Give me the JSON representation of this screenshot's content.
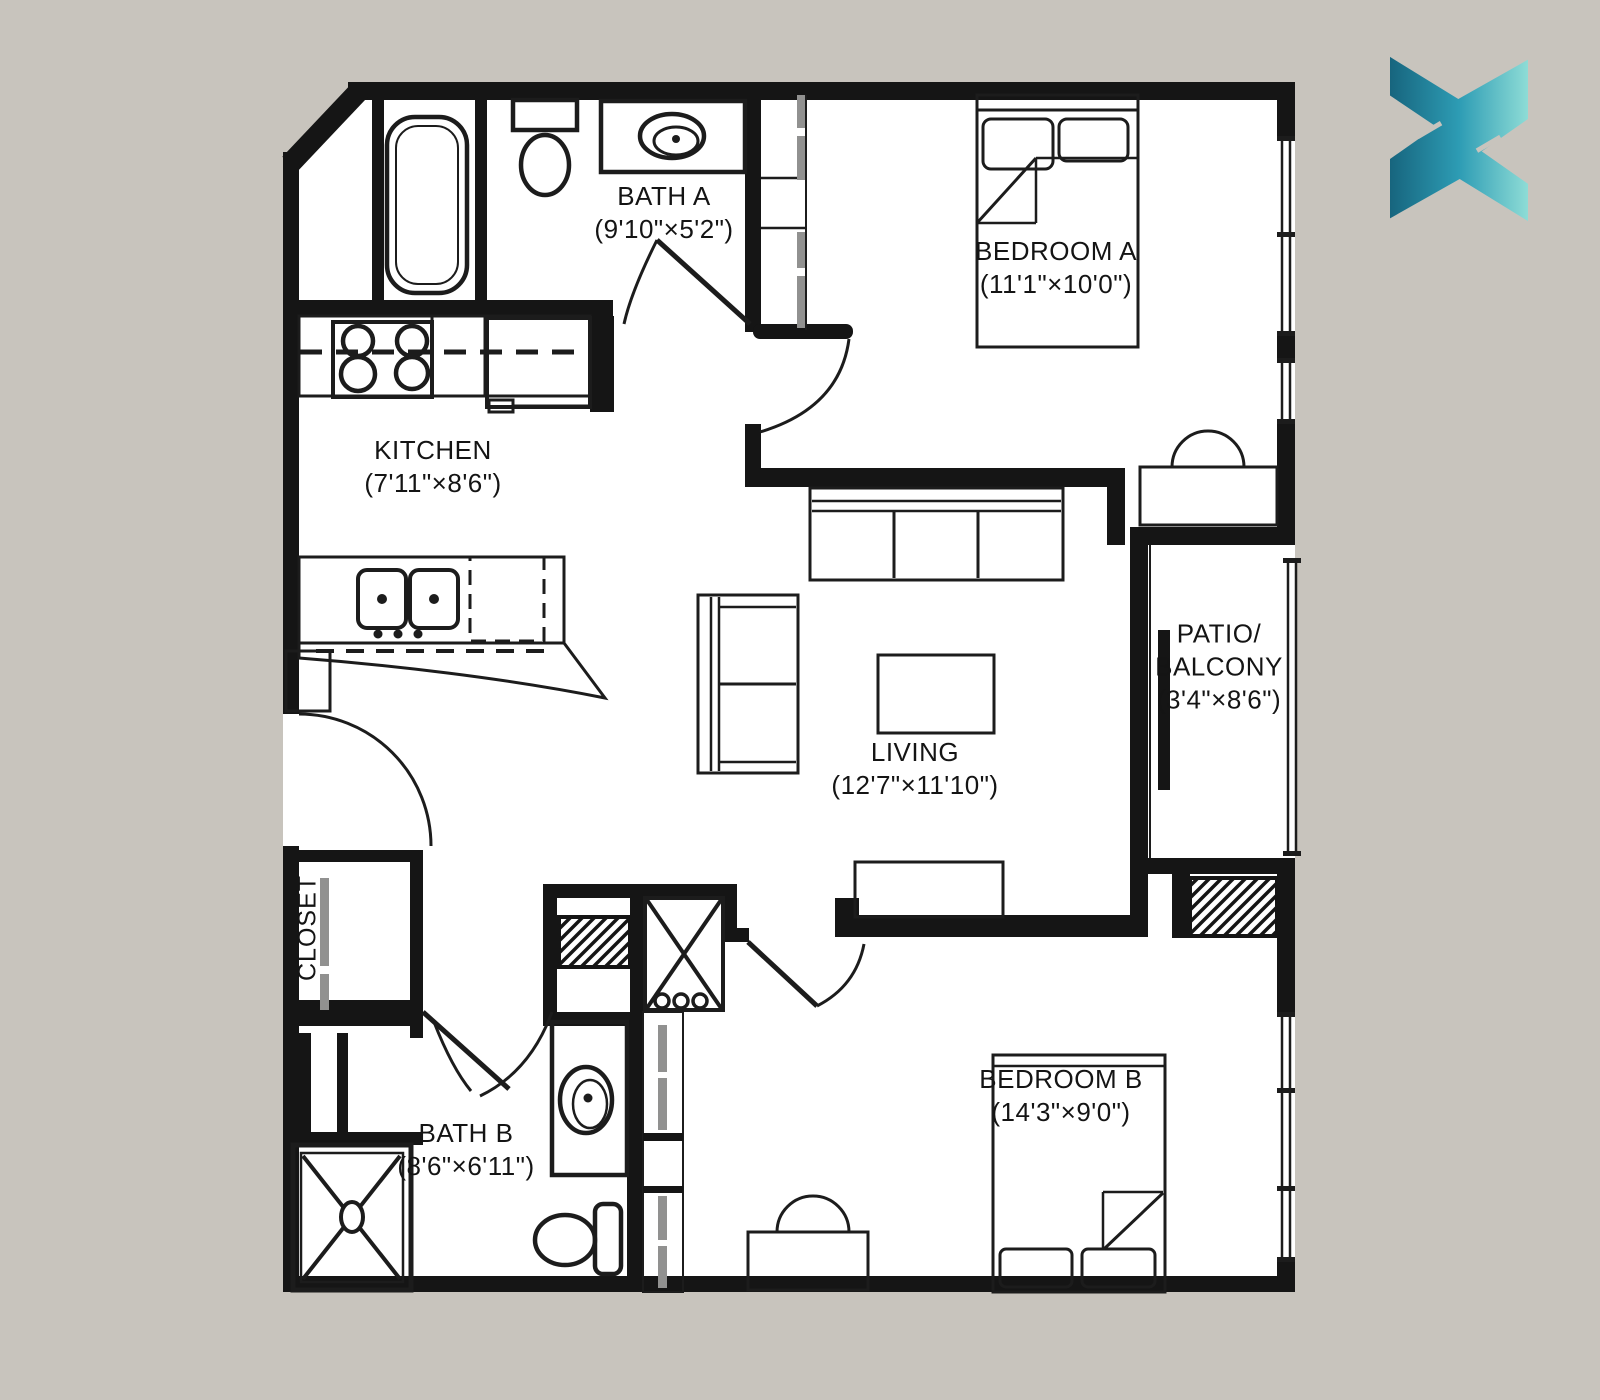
{
  "canvas": {
    "background_color": "#c8c4bd",
    "floor_color": "#ffffff",
    "wall_color": "#151515",
    "fixture_line_color": "#1c1c1c",
    "sliding_door_gray": "#919190"
  },
  "logo": {
    "name": "x-mark-logo",
    "gradient_start": "#17657e",
    "gradient_mid": "#2d9cb4",
    "gradient_end": "#8edcd6"
  },
  "rooms": {
    "bath_a": {
      "name": "BATH A",
      "dims": "(9'10\"×5'2\")"
    },
    "bedroom_a": {
      "name": "BEDROOM A",
      "dims": "(11'1\"×10'0\")"
    },
    "kitchen": {
      "name": "KITCHEN",
      "dims": "(7'11\"×8'6\")"
    },
    "living": {
      "name": "LIVING",
      "dims": "(12'7\"×11'10\")"
    },
    "patio": {
      "name_line1": "PATIO/",
      "name_line2": "BALCONY",
      "dims": "(3'4\"×8'6\")"
    },
    "closet": {
      "name": "CLOSET"
    },
    "bath_b": {
      "name": "BATH B",
      "dims": "(8'6\"×6'11\")"
    },
    "bedroom_b": {
      "name": "BEDROOM B",
      "dims": "(14'3\"×9'0\")"
    }
  }
}
